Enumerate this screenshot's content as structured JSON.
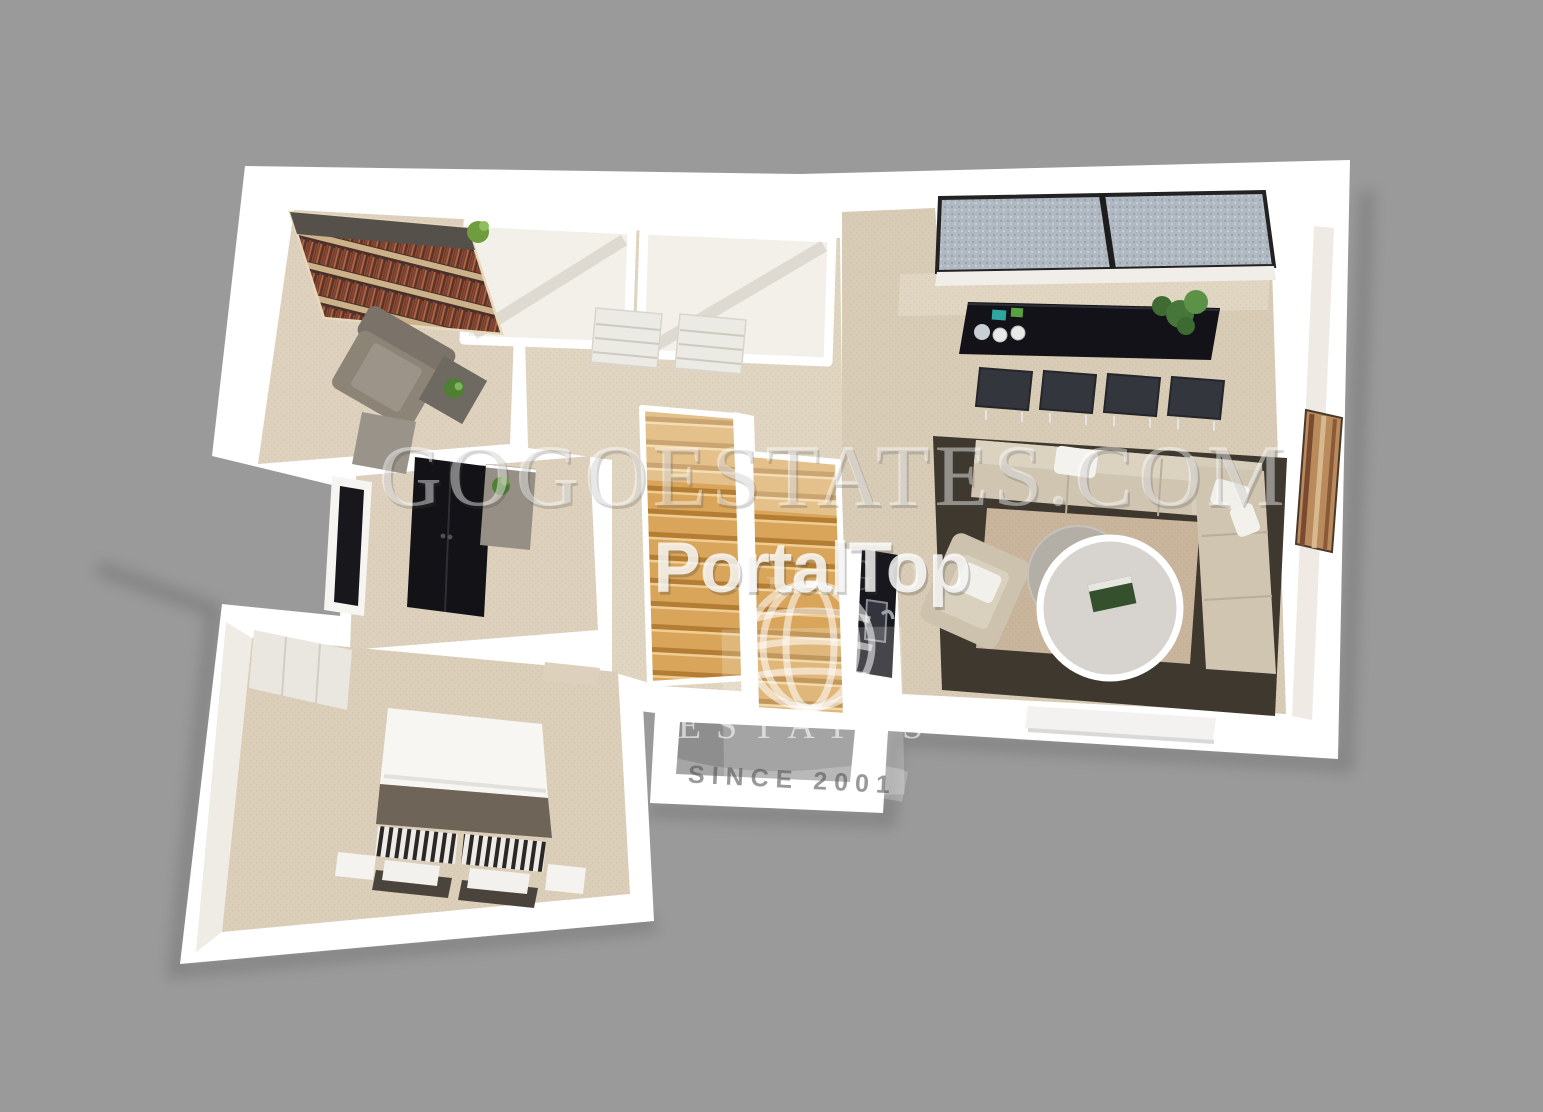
{
  "scene": {
    "type": "3d-floorplan-render",
    "description": "Top-down 3D dollhouse render of a one-bedroom apartment on a plain gray background",
    "rooms": [
      "study",
      "storage-room",
      "storage-room-2",
      "hallway",
      "staircase",
      "kitchenette",
      "living-dining-room",
      "small-bedroom",
      "main-bedroom"
    ]
  },
  "watermarks": {
    "site": "GOGOESTATES.COM",
    "portal": "PortalTop",
    "logo_monogram": "GOGO",
    "logo_name": "ESTATES",
    "logo_tagline": "SINCE 2001"
  },
  "colors": {
    "background": "#9a9a9a",
    "walls": "#ffffff",
    "floor_beige": "#ddd1bd",
    "stair_wood": "#d9a55a",
    "dining_table": "#15151b",
    "rug_dark": "#3e382e",
    "rug_inner": "#c8b59b",
    "sofa": "#cfc5b1",
    "bed_blanket": "#6e6458",
    "watermark_white": "rgba(255,255,255,0.45)"
  }
}
